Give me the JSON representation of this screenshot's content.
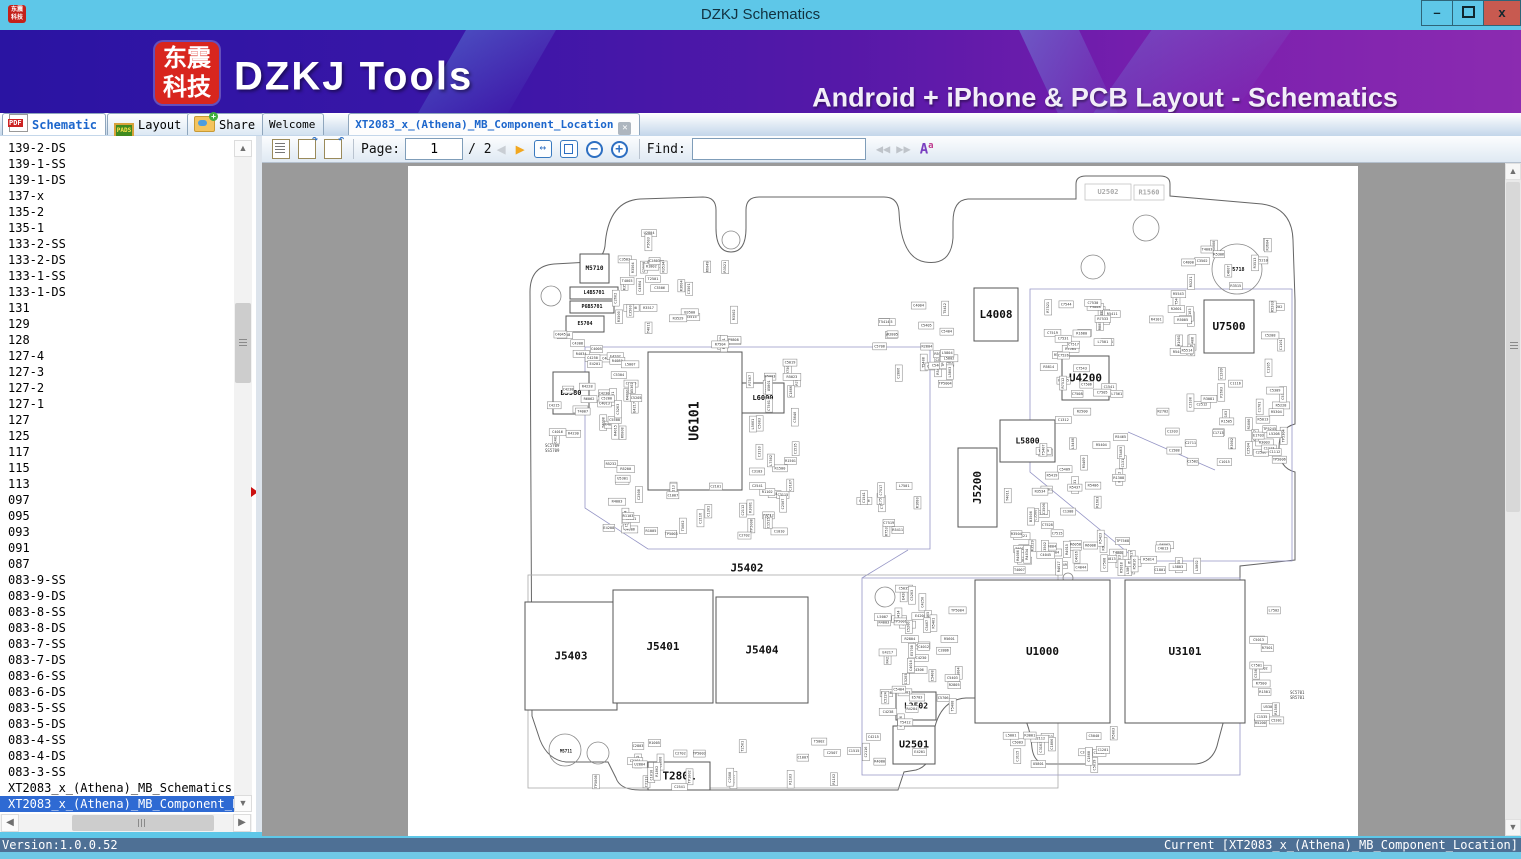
{
  "window": {
    "title": "DZKJ Schematics",
    "minimize_label": "–",
    "close_label": "x"
  },
  "header": {
    "logo_line1": "东震",
    "logo_line2": "科技",
    "brand": "DZKJ Tools",
    "tagline": "Android + iPhone & PCB Layout - Schematics",
    "accent_colors": {
      "banner_left": "#2a14a2",
      "banner_right": "#8b2bb0",
      "logo_red": "#d8261e"
    }
  },
  "tabs": {
    "main": [
      {
        "label": "Schematic",
        "icon": "pdf-icon",
        "active": true
      },
      {
        "label": "Layout",
        "icon": "pads-icon",
        "active": false
      },
      {
        "label": "Share",
        "icon": "share-icon",
        "active": false
      }
    ],
    "docs": [
      {
        "label": "Welcome",
        "active": false,
        "closable": false
      },
      {
        "label": "XT2083_x_(Athena)_MB_Component_Location",
        "active": true,
        "closable": true
      }
    ]
  },
  "toolbar": {
    "page_label": "Page:",
    "page_value": "1",
    "page_total": "/ 2",
    "find_label": "Find:",
    "find_value": "",
    "icons": [
      "notes-icon",
      "rotate-cw-icon",
      "rotate-ccw-icon",
      "prev-page-icon",
      "next-page-icon",
      "fit-width-icon",
      "fit-page-icon",
      "zoom-out-icon",
      "zoom-in-icon",
      "find-prev-icon",
      "find-next-icon",
      "font-case-icon"
    ]
  },
  "sidebar": {
    "items": [
      "139-2-DS",
      "139-1-SS",
      "139-1-DS",
      "137-x",
      "135-2",
      "135-1",
      "133-2-SS",
      "133-2-DS",
      "133-1-SS",
      "133-1-DS",
      "131",
      "129",
      "128",
      "127-4",
      "127-3",
      "127-2",
      "127-1",
      "127",
      "125",
      "117",
      "115",
      "113",
      "097",
      "095",
      "093",
      "091",
      "087",
      "083-9-SS",
      "083-9-DS",
      "083-8-SS",
      "083-8-DS",
      "083-7-SS",
      "083-7-DS",
      "083-6-SS",
      "083-6-DS",
      "083-5-SS",
      "083-5-DS",
      "083-4-SS",
      "083-4-DS",
      "083-3-SS",
      "XT2083_x_(Athena)_MB_Schematics",
      "XT2083_x_(Athena)_MB_Component_Location"
    ],
    "selected_index": 41
  },
  "statusbar": {
    "left": "Version:1.0.0.52",
    "right": "Current [XT2083_x_(Athena)_MB_Component_Location]"
  },
  "pcb": {
    "major_components": [
      {
        "label": "U6101",
        "x": 648,
        "y": 352,
        "w": 94,
        "h": 138,
        "vertical": true,
        "fs": 13
      },
      {
        "label": "L4008",
        "x": 974,
        "y": 288,
        "w": 44,
        "h": 53,
        "fs": 11
      },
      {
        "label": "U7500",
        "x": 1204,
        "y": 300,
        "w": 50,
        "h": 53,
        "fs": 11
      },
      {
        "label": "U4200",
        "x": 1062,
        "y": 356,
        "w": 47,
        "h": 44,
        "fs": 11
      },
      {
        "label": "J5200",
        "x": 958,
        "y": 448,
        "w": 39,
        "h": 79,
        "vertical": true,
        "fs": 11
      },
      {
        "label": "J5403",
        "x": 525,
        "y": 602,
        "w": 92,
        "h": 108,
        "fs": 11
      },
      {
        "label": "J5401",
        "x": 613,
        "y": 590,
        "w": 100,
        "h": 113,
        "fs": 11
      },
      {
        "label": "J5404",
        "x": 716,
        "y": 597,
        "w": 92,
        "h": 106,
        "fs": 11
      },
      {
        "label": "U1000",
        "x": 975,
        "y": 580,
        "w": 135,
        "h": 143,
        "fs": 11
      },
      {
        "label": "U3101",
        "x": 1125,
        "y": 580,
        "w": 120,
        "h": 143,
        "fs": 11
      },
      {
        "label": "U2501",
        "x": 893,
        "y": 726,
        "w": 42,
        "h": 38,
        "fs": 10
      },
      {
        "label": "L2502",
        "x": 896,
        "y": 692,
        "w": 40,
        "h": 28,
        "fs": 8
      },
      {
        "label": "T2801",
        "x": 648,
        "y": 762,
        "w": 62,
        "h": 28,
        "fs": 11
      },
      {
        "label": "U2502",
        "x": 1085,
        "y": 184,
        "w": 46,
        "h": 16,
        "fs": 7,
        "faint": true
      },
      {
        "label": "R1560",
        "x": 1134,
        "y": 185,
        "w": 30,
        "h": 15,
        "fs": 7,
        "faint": true
      },
      {
        "label": "M5710",
        "x": 580,
        "y": 254,
        "w": 29,
        "h": 29,
        "fs": 6
      },
      {
        "label": "B3580",
        "x": 553,
        "y": 372,
        "w": 36,
        "h": 42,
        "fs": 7
      },
      {
        "label": "L6000",
        "x": 742,
        "y": 383,
        "w": 42,
        "h": 30,
        "fs": 7
      },
      {
        "label": "L5800",
        "x": 1000,
        "y": 420,
        "w": 55,
        "h": 42,
        "fs": 8
      },
      {
        "label": "L4B5701",
        "x": 570,
        "y": 287,
        "w": 48,
        "h": 12,
        "fs": 5
      },
      {
        "label": "P6B5701",
        "x": 570,
        "y": 301,
        "w": 44,
        "h": 12,
        "fs": 5
      },
      {
        "label": "E5704",
        "x": 566,
        "y": 316,
        "w": 38,
        "h": 16,
        "fs": 5
      }
    ],
    "label_only": [
      {
        "label": "J5402",
        "x": 747,
        "y": 568,
        "fs": 11
      },
      {
        "label": "W5718",
        "x": 1237,
        "y": 270,
        "fs": 5
      },
      {
        "label": "M5711",
        "x": 566,
        "y": 751,
        "fs": 4
      }
    ],
    "tiny_texts": [
      {
        "lines": [
          "SC5709",
          "SS5709"
        ],
        "x": 545,
        "y": 447
      },
      {
        "lines": [
          "SC5701",
          "SR5701"
        ],
        "x": 1290,
        "y": 694
      }
    ],
    "small_labels": [
      "C3502",
      "R3513",
      "R3515",
      "R3604",
      "C4800",
      "C4807",
      "T4003",
      "T4011",
      "C4804",
      "C2602",
      "R3534",
      "R3521",
      "R3504",
      "R3502",
      "R3500",
      "C3500",
      "C3506",
      "B3500",
      "R3529",
      "R3517",
      "C3501",
      "R6049",
      "R6058",
      "T6014",
      "R6062",
      "R6008",
      "C1801",
      "C4045",
      "T4008",
      "T4007",
      "C4013",
      "C4023",
      "R4017",
      "R4015",
      "R4034",
      "C4016",
      "R4000",
      "C4005",
      "C4044",
      "C4238",
      "E4202",
      "C4215",
      "C4250",
      "R4228",
      "C4230",
      "R4230",
      "C4308",
      "E4201",
      "C4306",
      "E4217",
      "C4280",
      "R4284",
      "R4003",
      "R4080",
      "E4208",
      "C5035",
      "L5007",
      "R5232",
      "C5224",
      "C5200",
      "C5500",
      "C5203",
      "C5205",
      "R5200",
      "U5301",
      "U5302",
      "C5301",
      "C5304",
      "R1500",
      "R1501",
      "L7502",
      "R7500",
      "R7501",
      "C7501",
      "C1535",
      "R7507",
      "C5013",
      "C5003",
      "R5003",
      "U5801",
      "L5001",
      "C5040",
      "C5019",
      "R5023",
      "C3103",
      "C3110",
      "C3107",
      "C1806",
      "C1808",
      "C3115",
      "C2112",
      "C1201",
      "R3001",
      "R3000",
      "R1005",
      "R1103",
      "C2116",
      "C2113",
      "C1512",
      "C2101",
      "R1102",
      "C1010",
      "C1007",
      "TP1002",
      "TP5008",
      "TP5003",
      "T5002",
      "C2702",
      "C2541",
      "C2508",
      "C2507",
      "C1515",
      "T2501",
      "C2808",
      "R1802",
      "C2803",
      "U2804",
      "P5603",
      "C4012",
      "C4004",
      "C4010",
      "C5706",
      "E5708",
      "R2804",
      "R2805",
      "C2806",
      "T5408",
      "C5408",
      "C5405",
      "R5401",
      "E5703",
      "C5407",
      "T5414",
      "R5601",
      "T5412",
      "C5404",
      "C5403",
      "TP5001",
      "TP5004",
      "L5802",
      "L5804",
      "L5803",
      "L5801",
      "R5805",
      "R5816",
      "R5818",
      "R5813",
      "R5814",
      "C7508",
      "R8853",
      "P9808",
      "C7543",
      "R7521",
      "R7504",
      "C7506",
      "C1541",
      "C7544",
      "R1680",
      "C7530",
      "R5411",
      "R7533",
      "C7519",
      "C7517",
      "L7501",
      "R7505",
      "R7512",
      "C7526",
      "C7505",
      "C7531",
      "L7561",
      "C7528",
      "R7531",
      "TP7568",
      "TP7504",
      "C7515",
      "C1301",
      "R9280",
      "C2801",
      "C1304",
      "C1308",
      "R2500",
      "C1312",
      "C1313",
      "R5812",
      "R1308",
      "R5409",
      "R5423",
      "T5409",
      "C5409",
      "R5465",
      "L5400",
      "R5419",
      "R1603",
      "T5407",
      "R5437",
      "T5403",
      "R5404",
      "R5406",
      "R5445",
      "T5402",
      "C5402",
      "R5408",
      "T5401",
      "R4101",
      "R4103",
      "C1002",
      "C1082",
      "R2601",
      "R1001",
      "R5005",
      "R5514",
      "R5543",
      "C2502",
      "R5013",
      "R5604",
      "R1006",
      "C2504",
      "C2512",
      "C2506",
      "P2603",
      "C1713",
      "C1588",
      "R2702",
      "C2711",
      "TP5006",
      "C1209",
      "C1203",
      "C2103",
      "R3003",
      "C1105",
      "C1017",
      "C1015",
      "C2100",
      "C1701",
      "E1703",
      "R3081",
      "R3002",
      "R1505",
      "C1116",
      "C1113",
      "C1112",
      "C1101",
      "R5228",
      "C5202",
      "TP5245",
      "TP5304",
      "L5208",
      "C5305",
      "R5203",
      "C5208",
      "R5304",
      "C5309",
      "R5300",
      "R5306",
      "C5300",
      "TP5210",
      "R5221"
    ],
    "clusters": [
      {
        "x": 610,
        "y": 252,
        "w": 128,
        "h": 88,
        "n": 22
      },
      {
        "x": 536,
        "y": 318,
        "w": 96,
        "h": 130,
        "n": 26
      },
      {
        "x": 598,
        "y": 352,
        "w": 44,
        "h": 185,
        "n": 20
      },
      {
        "x": 746,
        "y": 350,
        "w": 58,
        "h": 148,
        "n": 20
      },
      {
        "x": 618,
        "y": 482,
        "w": 180,
        "h": 58,
        "n": 24
      },
      {
        "x": 640,
        "y": 228,
        "w": 22,
        "h": 58,
        "n": 6
      },
      {
        "x": 872,
        "y": 296,
        "w": 82,
        "h": 96,
        "n": 16
      },
      {
        "x": 938,
        "y": 300,
        "w": 20,
        "h": 88,
        "n": 8
      },
      {
        "x": 1035,
        "y": 288,
        "w": 92,
        "h": 118,
        "n": 28
      },
      {
        "x": 1035,
        "y": 408,
        "w": 98,
        "h": 148,
        "n": 28
      },
      {
        "x": 1140,
        "y": 288,
        "w": 58,
        "h": 68,
        "n": 14
      },
      {
        "x": 1150,
        "y": 358,
        "w": 138,
        "h": 108,
        "n": 28
      },
      {
        "x": 1260,
        "y": 298,
        "w": 32,
        "h": 158,
        "n": 12
      },
      {
        "x": 1176,
        "y": 238,
        "w": 98,
        "h": 52,
        "n": 12
      },
      {
        "x": 1000,
        "y": 466,
        "w": 58,
        "h": 92,
        "n": 12
      },
      {
        "x": 1010,
        "y": 540,
        "w": 178,
        "h": 36,
        "n": 20
      },
      {
        "x": 864,
        "y": 580,
        "w": 66,
        "h": 192,
        "n": 24
      },
      {
        "x": 1248,
        "y": 580,
        "w": 36,
        "h": 148,
        "n": 14
      },
      {
        "x": 1000,
        "y": 726,
        "w": 118,
        "h": 48,
        "n": 16
      },
      {
        "x": 590,
        "y": 738,
        "w": 288,
        "h": 54,
        "n": 24
      },
      {
        "x": 884,
        "y": 598,
        "w": 88,
        "h": 128,
        "n": 22
      },
      {
        "x": 1095,
        "y": 554,
        "w": 108,
        "h": 24,
        "n": 10
      },
      {
        "x": 700,
        "y": 336,
        "w": 58,
        "h": 12,
        "n": 5
      },
      {
        "x": 856,
        "y": 470,
        "w": 70,
        "h": 70,
        "n": 10
      }
    ]
  }
}
